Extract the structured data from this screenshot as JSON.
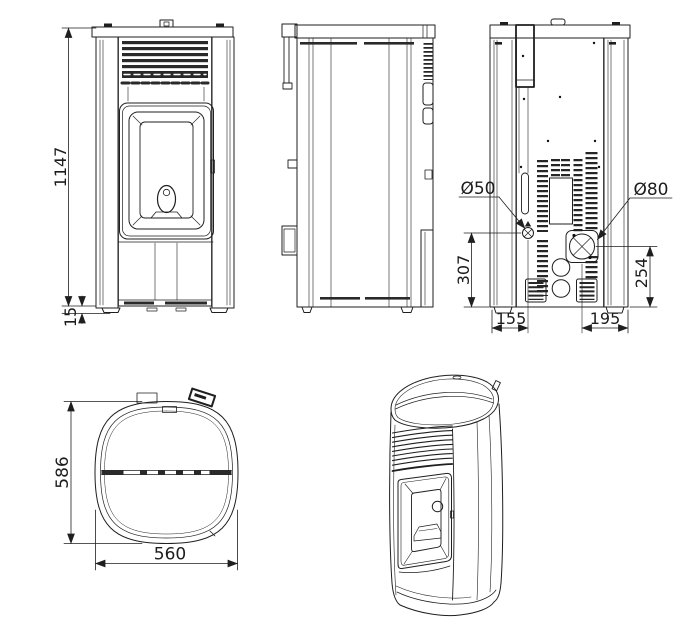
{
  "drawing": {
    "background": "#ffffff",
    "line_color": "#1f1f1f",
    "views": {
      "front": {
        "label_overall_height": "1147",
        "label_base_height": "15"
      },
      "rear": {
        "label_air_intake_diameter": "Ø50",
        "label_flue_diameter": "Ø80",
        "label_air_intake_center_height": "307",
        "label_flue_center_height": "254",
        "label_air_intake_center_offset": "155",
        "label_flue_center_offset": "195"
      },
      "top": {
        "label_depth": "586",
        "label_width": "560"
      }
    }
  }
}
